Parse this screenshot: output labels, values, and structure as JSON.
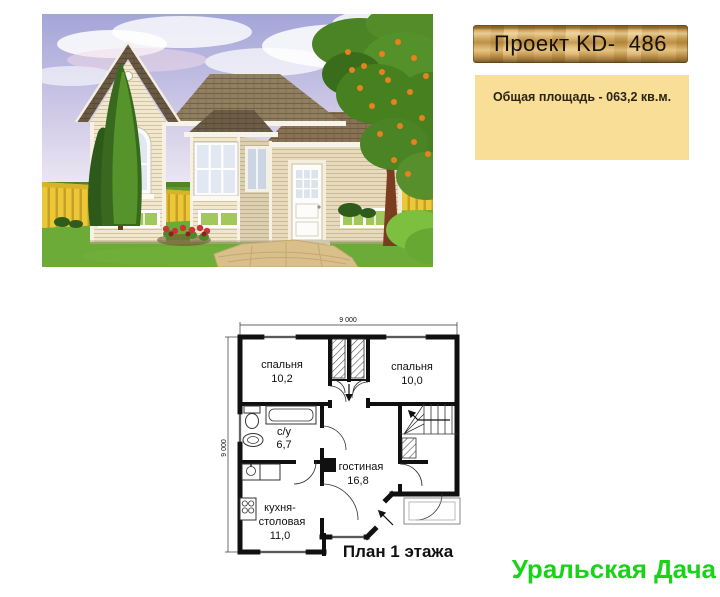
{
  "page": {
    "background": "#ffffff"
  },
  "header": {
    "project_label": "Проект KD-  486",
    "area_label": "Общая площадь - 063,2 кв.м.",
    "plank_wood_color": "#cda55c",
    "area_box_color": "#f9de97"
  },
  "photo": {
    "sky_color": "#a4a5d8",
    "lawn_color": "#5f9b2f",
    "wall_color": "#f1e7cc",
    "roof_color": "#6a5a44",
    "fence_color": "#eac838"
  },
  "floorplan": {
    "dim_top": "9 000",
    "dim_left": "9 000",
    "rooms": [
      {
        "name": "спальня",
        "area": "10,2"
      },
      {
        "name": "спальня",
        "area": "10,0"
      },
      {
        "name": "с/у",
        "area": "6,7"
      },
      {
        "name": "гостиная",
        "area": "16,8"
      },
      {
        "name": "кухня-",
        "name2": "столовая",
        "area": "11,0"
      }
    ],
    "caption": "План 1 этажа",
    "ink_color": "#101010"
  },
  "brand": {
    "text": "Уральская Дача",
    "color": "#19d319"
  }
}
